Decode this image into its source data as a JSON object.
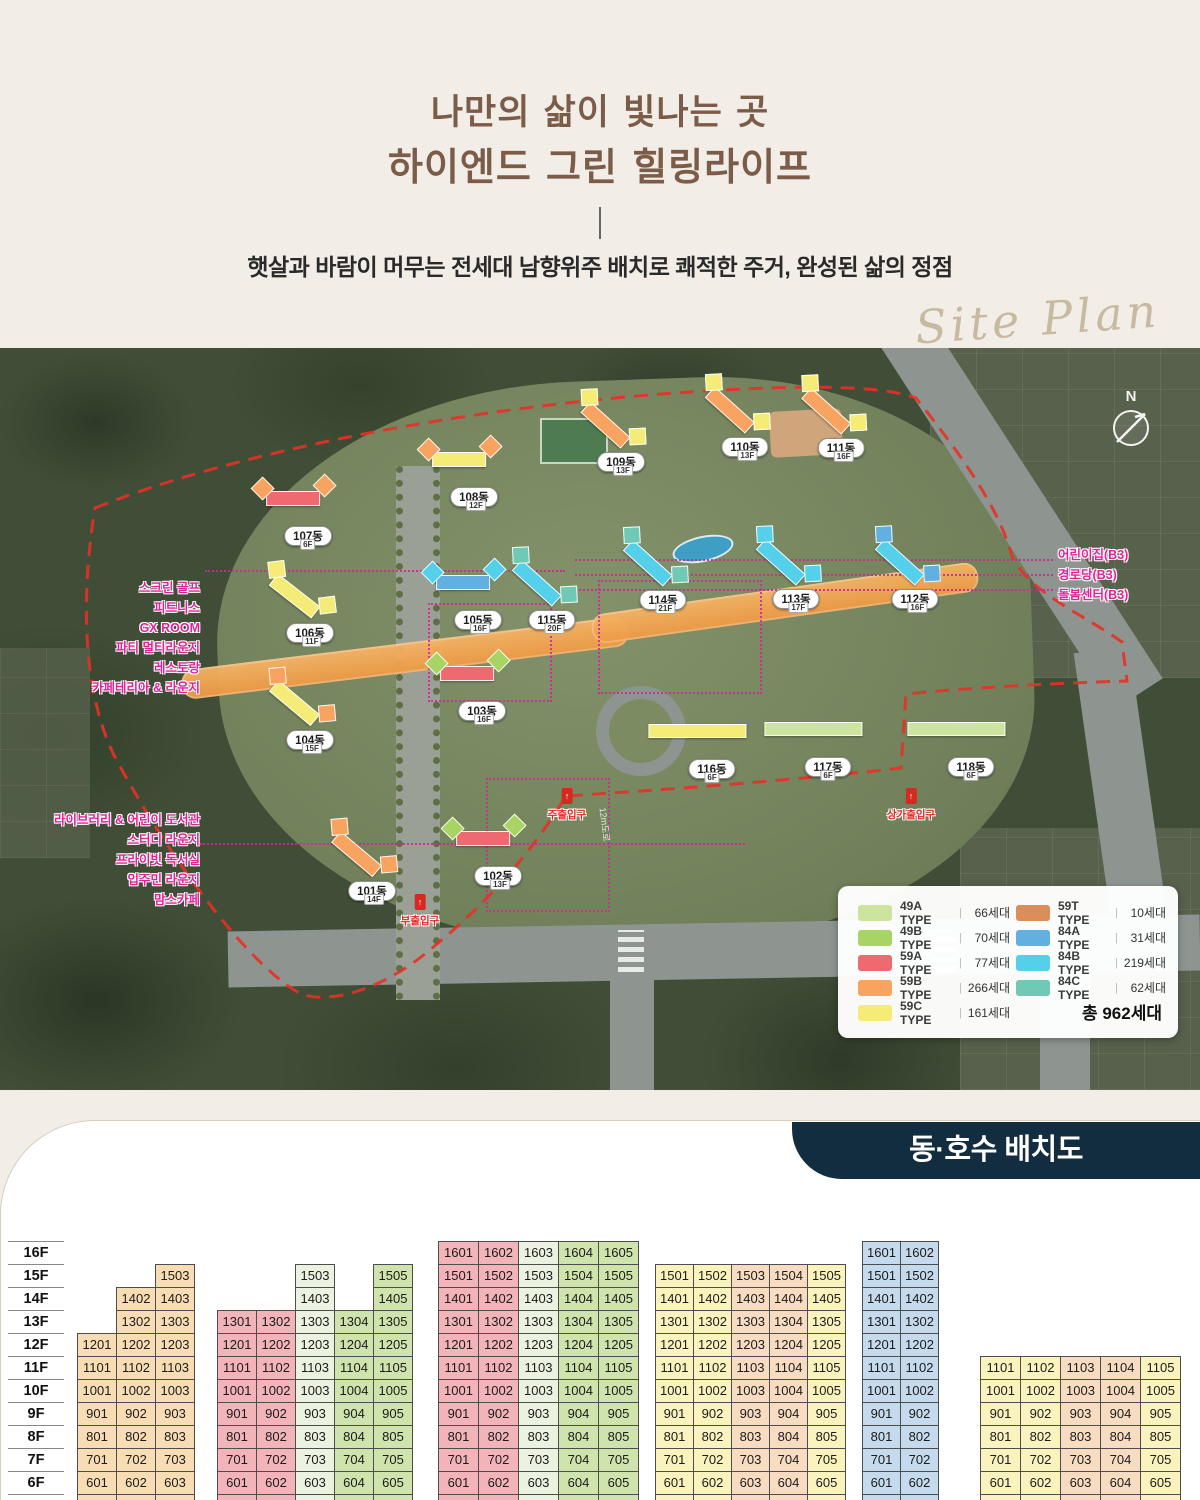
{
  "header": {
    "title1": "나만의 삶이 빛나는 곳",
    "title2": "하이엔드 그린 힐링라이프",
    "subtitle": "햇살과 바람이 머무는 전세대 남향위주 배치로 쾌적한 주거, 완성된 삶의 정점",
    "watermark": "Site Plan"
  },
  "site_plan": {
    "north_label": "N",
    "road_label": "12m도로",
    "type_colors": {
      "49A": "#cde49e",
      "49B": "#a8d365",
      "59A": "#ef6a70",
      "59B": "#f9a360",
      "59C": "#f4ec77",
      "59T": "#db8e59",
      "84A": "#62b0e2",
      "84B": "#55d0ea",
      "84C": "#6fc9b4"
    },
    "buildings": [
      {
        "name": "101동",
        "x": 372,
        "y": 543,
        "rot": 40,
        "c1": "59B",
        "c2": "59B",
        "chip": "14F",
        "low": false
      },
      {
        "name": "102동",
        "x": 498,
        "y": 528,
        "rot": 0,
        "c1": "59A",
        "c2": "49B",
        "chip": "13F",
        "low": false
      },
      {
        "name": "103동",
        "x": 482,
        "y": 363,
        "rot": 0,
        "c1": "59A",
        "c2": "49B",
        "chip": "16F",
        "low": false
      },
      {
        "name": "104동",
        "x": 310,
        "y": 392,
        "rot": 40,
        "c1": "59C",
        "c2": "59B",
        "chip": "15F",
        "low": false
      },
      {
        "name": "105동",
        "x": 478,
        "y": 272,
        "rot": 0,
        "c1": "84A",
        "c2": "84B",
        "chip": "16F",
        "low": false
      },
      {
        "name": "106동",
        "x": 310,
        "y": 285,
        "rot": 38,
        "c1": "59C",
        "c2": "59C",
        "chip": "11F",
        "low": false
      },
      {
        "name": "107동",
        "x": 308,
        "y": 188,
        "rot": 0,
        "c1": "59A",
        "c2": "59B",
        "chip": "6F",
        "low": false
      },
      {
        "name": "108동",
        "x": 474,
        "y": 149,
        "rot": 0,
        "c1": "59C",
        "c2": "59B",
        "chip": "12F",
        "low": false
      },
      {
        "name": "109동",
        "x": 621,
        "y": 114,
        "rot": 42,
        "c1": "59B",
        "c2": "59C",
        "chip": "13F",
        "low": false
      },
      {
        "name": "110동",
        "x": 745,
        "y": 99,
        "rot": 42,
        "c1": "59B",
        "c2": "59C",
        "chip": "13F",
        "low": false
      },
      {
        "name": "111동",
        "x": 841,
        "y": 100,
        "rot": 42,
        "c1": "59B",
        "c2": "59C",
        "chip": "16F",
        "low": false
      },
      {
        "name": "112동",
        "x": 915,
        "y": 251,
        "rot": 42,
        "c1": "84B",
        "c2": "84A",
        "chip": "16F",
        "low": false
      },
      {
        "name": "113동",
        "x": 796,
        "y": 251,
        "rot": 42,
        "c1": "84B",
        "c2": "84B",
        "chip": "17F",
        "low": false
      },
      {
        "name": "114동",
        "x": 663,
        "y": 252,
        "rot": 42,
        "c1": "84B",
        "c2": "84C",
        "chip": "21F",
        "low": false
      },
      {
        "name": "115동",
        "x": 552,
        "y": 272,
        "rot": 42,
        "c1": "84B",
        "c2": "84C",
        "chip": "20F",
        "low": false
      },
      {
        "name": "116동",
        "x": 712,
        "y": 421,
        "rot": 0,
        "c1": "59C",
        "c2": "59C",
        "chip": "6F",
        "low": true
      },
      {
        "name": "117동",
        "x": 828,
        "y": 419,
        "rot": 0,
        "c1": "49A",
        "c2": "49A",
        "chip": "6F",
        "low": true
      },
      {
        "name": "118동",
        "x": 971,
        "y": 419,
        "rot": 0,
        "c1": "49A",
        "c2": "49A",
        "chip": "6F",
        "low": true
      }
    ],
    "amenities_left_top": [
      "스크린 골프",
      "피트니스",
      "GX ROOM",
      "파티 멀티라운지",
      "레스토랑",
      "카페테리아 & 라운지"
    ],
    "amenities_left_bottom": [
      "라이브러리 & 어린이 도서관",
      "스터디 라운지",
      "프라이빗 독서실",
      "입주민 라운지",
      "맘스카페"
    ],
    "amenities_right": [
      "어린이집(B3)",
      "경로당(B3)",
      "돌봄센터(B3)"
    ],
    "entrances": [
      {
        "label": "주출입구",
        "x": 567,
        "y": 440
      },
      {
        "label": "부출입구",
        "x": 420,
        "y": 546
      },
      {
        "label": "상가출입구",
        "x": 911,
        "y": 440
      }
    ],
    "legend": {
      "items": [
        {
          "label": "49A TYPE",
          "count": "66세대",
          "color": "#cde49e"
        },
        {
          "label": "49B TYPE",
          "count": "70세대",
          "color": "#a8d365"
        },
        {
          "label": "59A TYPE",
          "count": "77세대",
          "color": "#ef6a70"
        },
        {
          "label": "59B TYPE",
          "count": "266세대",
          "color": "#f9a360"
        },
        {
          "label": "59C TYPE",
          "count": "161세대",
          "color": "#f4ec77"
        },
        {
          "label": "59T TYPE",
          "count": "10세대",
          "color": "#db8e59"
        },
        {
          "label": "84A TYPE",
          "count": "31세대",
          "color": "#62b0e2"
        },
        {
          "label": "84B TYPE",
          "count": "219세대",
          "color": "#55d0ea"
        },
        {
          "label": "84C TYPE",
          "count": "62세대",
          "color": "#6fc9b4"
        }
      ],
      "total": "총 962세대"
    }
  },
  "section": {
    "badge": "동·호수 배치도"
  },
  "unit_tables": {
    "floors": [
      "16F",
      "15F",
      "14F",
      "13F",
      "12F",
      "11F",
      "10F",
      "9F",
      "8F",
      "7F",
      "6F",
      "5F"
    ],
    "cell_colors": {
      "tan": "#f8dcb4",
      "pink": "#f2b4b9",
      "ltgreen": "#ebf2e0",
      "green": "#cfe3ac",
      "yellow": "#faf3bd",
      "peach": "#f8dcc2",
      "blue": "#c6daee"
    },
    "tables": [
      {
        "x": 77,
        "cw": 39,
        "cols": [
          "tan",
          "tan",
          "tan"
        ],
        "rows": {
          "15F": [
            null,
            null,
            "1503"
          ],
          "14F": [
            null,
            "1402",
            "1403"
          ],
          "13F": [
            null,
            "1302",
            "1303"
          ],
          "12F": [
            "1201",
            "1202",
            "1203"
          ],
          "11F": [
            "1101",
            "1102",
            "1103"
          ],
          "10F": [
            "1001",
            "1002",
            "1003"
          ],
          "9F": [
            "901",
            "902",
            "903"
          ],
          "8F": [
            "801",
            "802",
            "803"
          ],
          "7F": [
            "701",
            "702",
            "703"
          ],
          "6F": [
            "601",
            "602",
            "603"
          ],
          "5F": [
            "501",
            "502",
            "503"
          ]
        }
      },
      {
        "x": 217,
        "cw": 39,
        "cols": [
          "pink",
          "pink",
          "ltgreen",
          "green",
          "green"
        ],
        "rows": {
          "15F": [
            null,
            null,
            "1503",
            null,
            "1505"
          ],
          "14F": [
            null,
            null,
            "1403",
            null,
            "1405"
          ],
          "13F": [
            "1301",
            "1302",
            "1303",
            "1304",
            "1305"
          ],
          "12F": [
            "1201",
            "1202",
            "1203",
            "1204",
            "1205"
          ],
          "11F": [
            "1101",
            "1102",
            "1103",
            "1104",
            "1105"
          ],
          "10F": [
            "1001",
            "1002",
            "1003",
            "1004",
            "1005"
          ],
          "9F": [
            "901",
            "902",
            "903",
            "904",
            "905"
          ],
          "8F": [
            "801",
            "802",
            "803",
            "804",
            "805"
          ],
          "7F": [
            "701",
            "702",
            "703",
            "704",
            "705"
          ],
          "6F": [
            "601",
            "602",
            "603",
            "604",
            "605"
          ],
          "5F": [
            "501",
            "502",
            "503",
            "504",
            "505"
          ]
        }
      },
      {
        "x": 438,
        "cw": 40,
        "cols": [
          "pink",
          "pink",
          "ltgreen",
          "green",
          "green"
        ],
        "rows": {
          "16F": [
            "1601",
            "1602",
            "1603",
            "1604",
            "1605"
          ],
          "15F": [
            "1501",
            "1502",
            "1503",
            "1504",
            "1505"
          ],
          "14F": [
            "1401",
            "1402",
            "1403",
            "1404",
            "1405"
          ],
          "13F": [
            "1301",
            "1302",
            "1303",
            "1304",
            "1305"
          ],
          "12F": [
            "1201",
            "1202",
            "1203",
            "1204",
            "1205"
          ],
          "11F": [
            "1101",
            "1102",
            "1103",
            "1104",
            "1105"
          ],
          "10F": [
            "1001",
            "1002",
            "1003",
            "1004",
            "1005"
          ],
          "9F": [
            "901",
            "902",
            "903",
            "904",
            "905"
          ],
          "8F": [
            "801",
            "802",
            "803",
            "804",
            "805"
          ],
          "7F": [
            "701",
            "702",
            "703",
            "704",
            "705"
          ],
          "6F": [
            "601",
            "602",
            "603",
            "604",
            "605"
          ],
          "5F": [
            "501",
            "502",
            "503",
            "504",
            "505"
          ]
        }
      },
      {
        "x": 655,
        "cw": 38,
        "cols": [
          "yellow",
          "yellow",
          "peach",
          "peach",
          "yellow"
        ],
        "rows": {
          "15F": [
            "1501",
            "1502",
            "1503",
            "1504",
            "1505"
          ],
          "14F": [
            "1401",
            "1402",
            "1403",
            "1404",
            "1405"
          ],
          "13F": [
            "1301",
            "1302",
            "1303",
            "1304",
            "1305"
          ],
          "12F": [
            "1201",
            "1202",
            "1203",
            "1204",
            "1205"
          ],
          "11F": [
            "1101",
            "1102",
            "1103",
            "1104",
            "1105"
          ],
          "10F": [
            "1001",
            "1002",
            "1003",
            "1004",
            "1005"
          ],
          "9F": [
            "901",
            "902",
            "903",
            "904",
            "905"
          ],
          "8F": [
            "801",
            "802",
            "803",
            "804",
            "805"
          ],
          "7F": [
            "701",
            "702",
            "703",
            "704",
            "705"
          ],
          "6F": [
            "601",
            "602",
            "603",
            "604",
            "605"
          ],
          "5F": [
            "501",
            "502",
            "503",
            "504",
            "505"
          ]
        }
      },
      {
        "x": 862,
        "cw": 38,
        "cols": [
          "blue",
          "blue"
        ],
        "rows": {
          "16F": [
            "1601",
            "1602"
          ],
          "15F": [
            "1501",
            "1502"
          ],
          "14F": [
            "1401",
            "1402"
          ],
          "13F": [
            "1301",
            "1302"
          ],
          "12F": [
            "1201",
            "1202"
          ],
          "11F": [
            "1101",
            "1102"
          ],
          "10F": [
            "1001",
            "1002"
          ],
          "9F": [
            "901",
            "902"
          ],
          "8F": [
            "801",
            "802"
          ],
          "7F": [
            "701",
            "702"
          ],
          "6F": [
            "601",
            "602"
          ],
          "5F": [
            "501",
            "502"
          ]
        }
      },
      {
        "x": 980,
        "cw": 40,
        "cols": [
          "yellow",
          "yellow",
          "peach",
          "peach",
          "yellow"
        ],
        "rows": {
          "11F": [
            "1101",
            "1102",
            "1103",
            "1104",
            "1105"
          ],
          "10F": [
            "1001",
            "1002",
            "1003",
            "1004",
            "1005"
          ],
          "9F": [
            "901",
            "902",
            "903",
            "904",
            "905"
          ],
          "8F": [
            "801",
            "802",
            "803",
            "804",
            "805"
          ],
          "7F": [
            "701",
            "702",
            "703",
            "704",
            "705"
          ],
          "6F": [
            "601",
            "602",
            "603",
            "604",
            "605"
          ],
          "5F": [
            "501",
            "502",
            "503",
            "504",
            "505"
          ]
        }
      }
    ]
  }
}
